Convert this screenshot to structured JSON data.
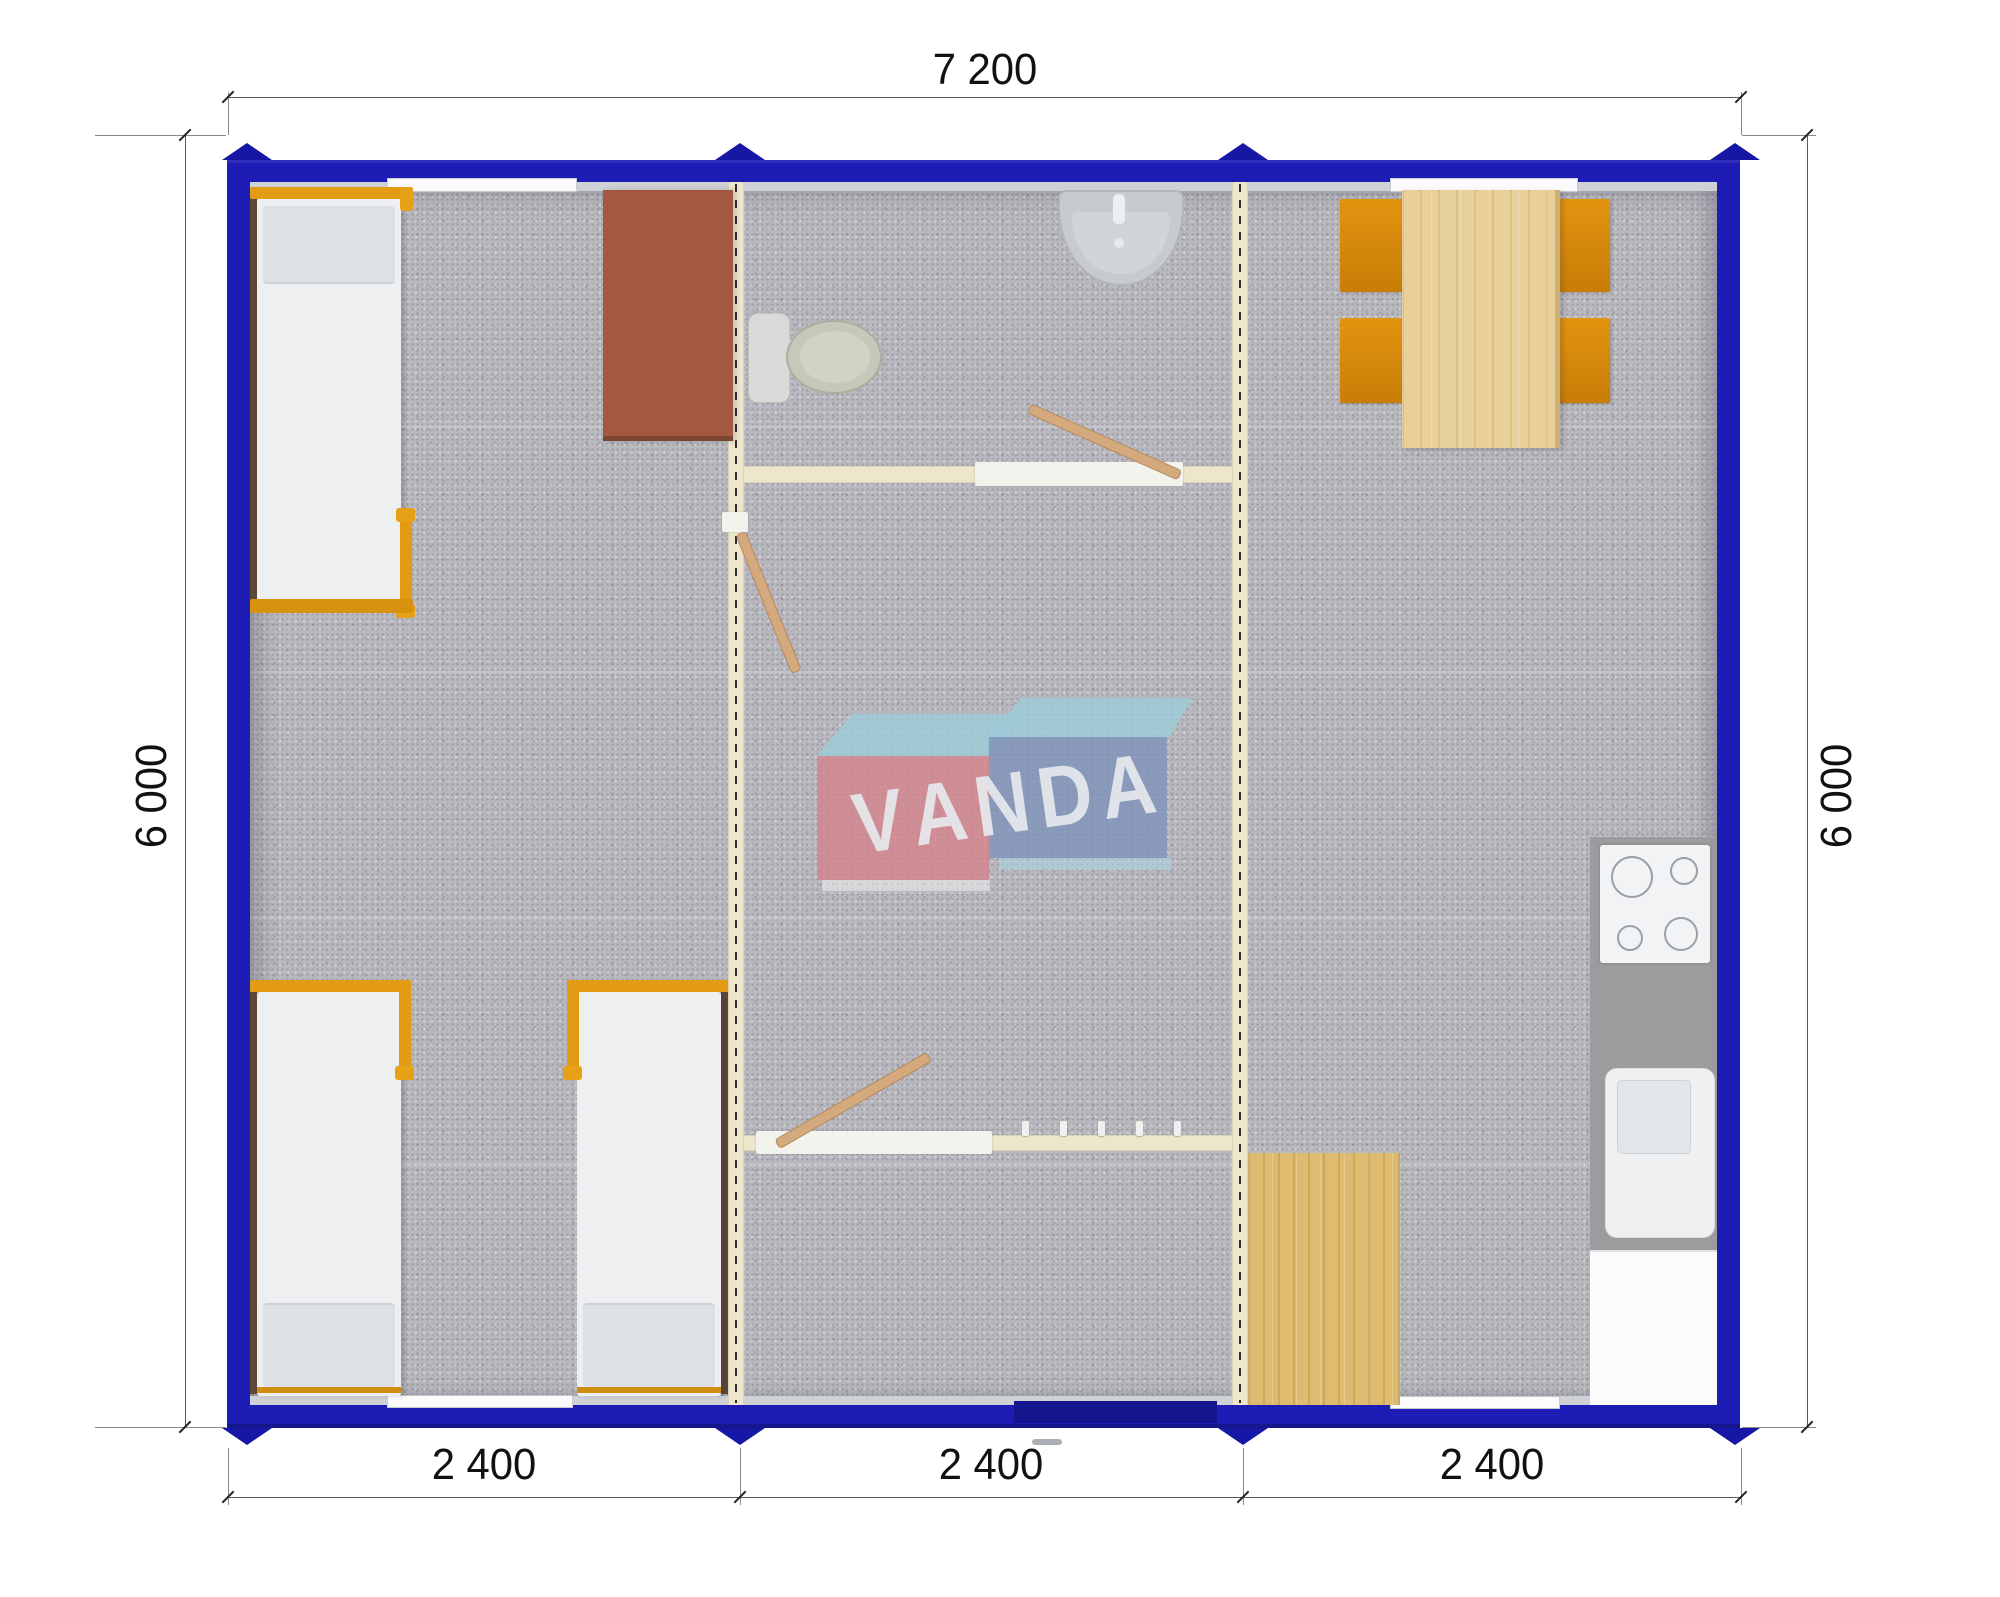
{
  "plan": {
    "type": "modular container house floor plan, top view",
    "dimensions": {
      "width_label": "7 200",
      "height_label_left": "6 000",
      "height_label_right": "6 000",
      "module_labels": [
        "2 400",
        "2 400",
        "2 400"
      ]
    },
    "watermark": {
      "brand": "VANDA",
      "letters": [
        "V",
        "A",
        "N",
        "D",
        "A"
      ],
      "box_colors": {
        "left_box": "#d4858d",
        "right_box": "#8094ba",
        "top_faces": "#9ecad8"
      }
    },
    "colors": {
      "wall": "#1d1db5",
      "module_joint_marker": "#1717a6",
      "entrance_door": "#15158e",
      "partition": "#ede6cd",
      "floor_carpet": "#b8b8be",
      "bed_frame_orange": "#e29b12",
      "chair_orange": "#dd8b07",
      "table_wood": "#e8d09b",
      "mat_wood": "#debb6f",
      "desk_brown": "#a3583f",
      "door_leaf": "#d5a97e",
      "kitchen_counter": "#9c9c9e",
      "fixture_white": "#eef0f1"
    },
    "objects": [
      "bed",
      "bed",
      "bed",
      "desk",
      "toilet",
      "wash-basin",
      "dining-table",
      "chair",
      "chair",
      "chair",
      "chair",
      "stove",
      "kitchen-sink",
      "cabinet",
      "wood-mat",
      "coat-hooks",
      "entrance-door",
      "windows"
    ]
  }
}
